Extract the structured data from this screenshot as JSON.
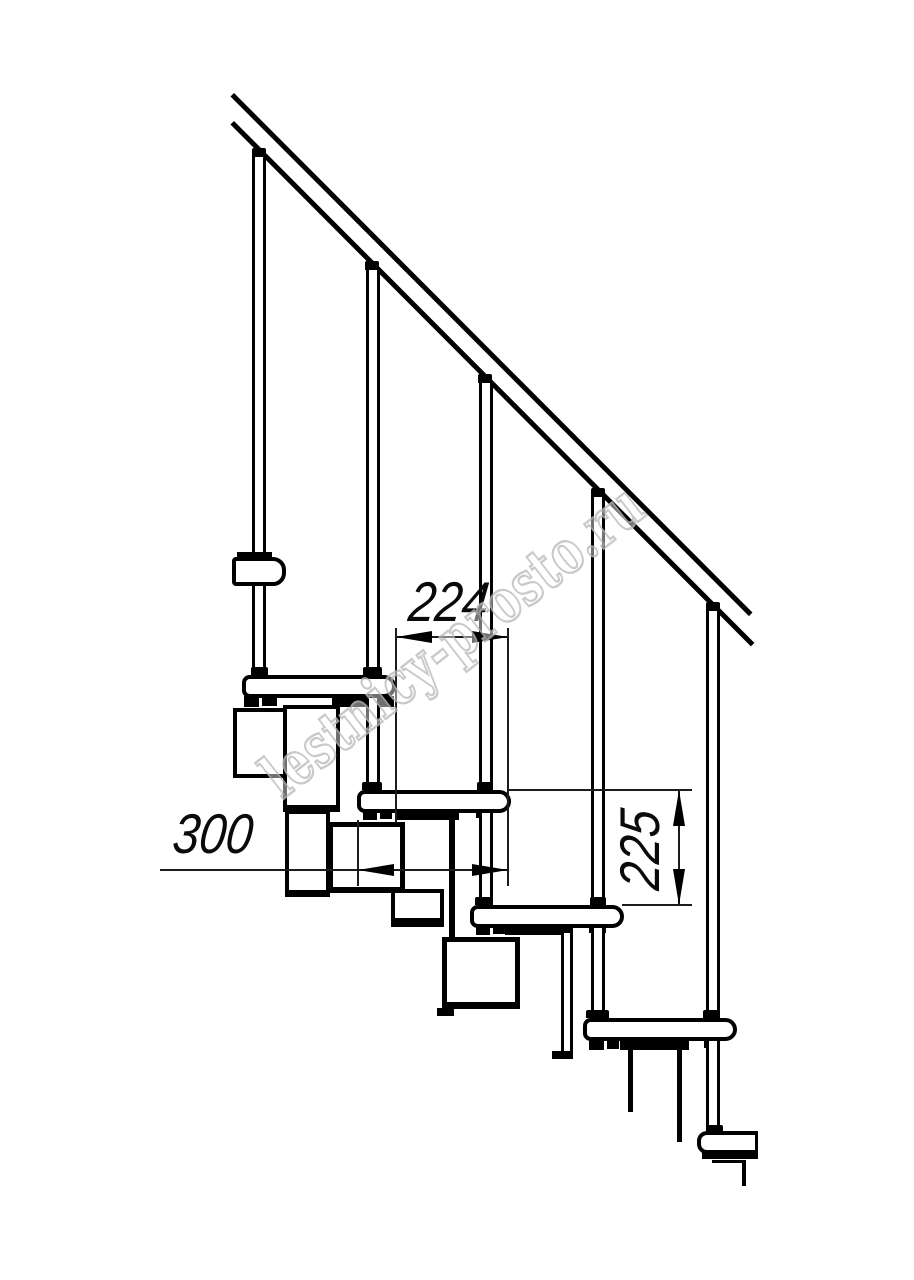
{
  "drawing": {
    "title": "modular-staircase-side-view",
    "dimensions": {
      "run_between_posts": "224",
      "step_module_depth": "300",
      "riser_height": "225"
    },
    "watermark": "lestnicy-prosto.ru",
    "colors": {
      "line": "#000000",
      "thin_line": "#1c1c1c",
      "watermark_outline": "#bcbcbc",
      "background": "#ffffff"
    }
  }
}
